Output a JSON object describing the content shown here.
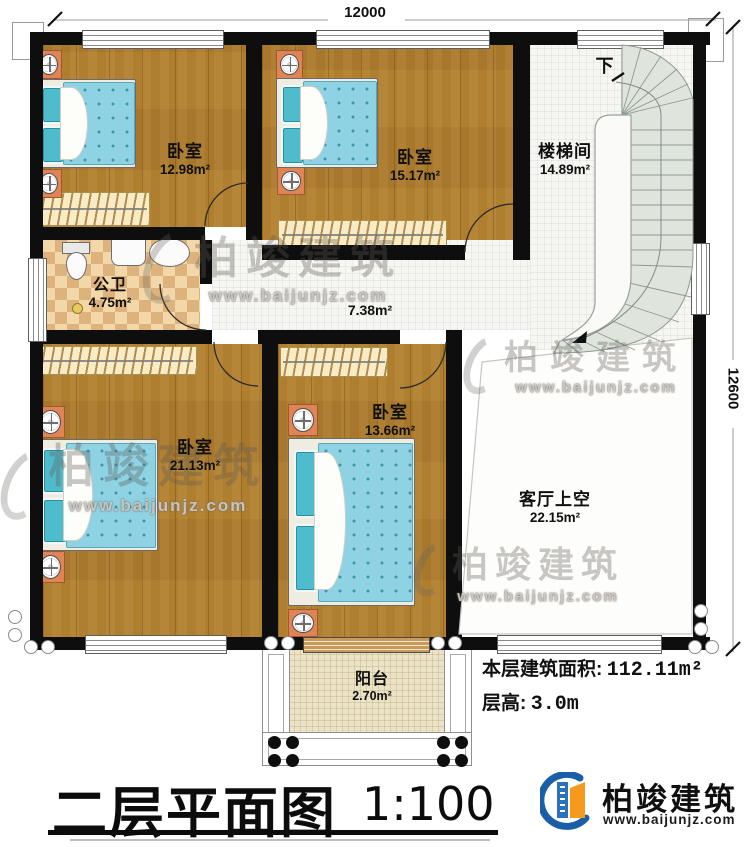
{
  "title": {
    "text": "二层平面图",
    "scale": "1:100"
  },
  "dimensions": {
    "width": "12000",
    "height": "12600"
  },
  "rooms": [
    {
      "id": "bedroom-top-left",
      "label": "卧室",
      "area": "12.98m²"
    },
    {
      "id": "bedroom-top-middle",
      "label": "卧室",
      "area": "15.17m²"
    },
    {
      "id": "stairwell",
      "label": "楼梯间",
      "area": "14.89m²"
    },
    {
      "id": "bathroom",
      "label": "公卫",
      "area": "4.75m²"
    },
    {
      "id": "corridor",
      "area": "7.38m²"
    },
    {
      "id": "bedroom-bottom-left",
      "label": "卧室",
      "area": "21.13m²"
    },
    {
      "id": "bedroom-bottom-middle",
      "label": "卧室",
      "area": "13.66m²"
    },
    {
      "id": "living-void",
      "label": "客厅上空",
      "area": "22.15m²"
    },
    {
      "id": "balcony",
      "label": "阳台",
      "area": "2.70m²"
    }
  ],
  "stair": {
    "down": "下"
  },
  "info": {
    "area_label": "本层建筑面积:",
    "area_value": "112.11m²",
    "height_label": "层高:",
    "height_value": "3.0m"
  },
  "brand": {
    "name": "柏竣建筑",
    "website": "www.baijunjz.com"
  },
  "watermark": {
    "name": "柏竣建筑",
    "website": "www.baijunjz.com"
  }
}
